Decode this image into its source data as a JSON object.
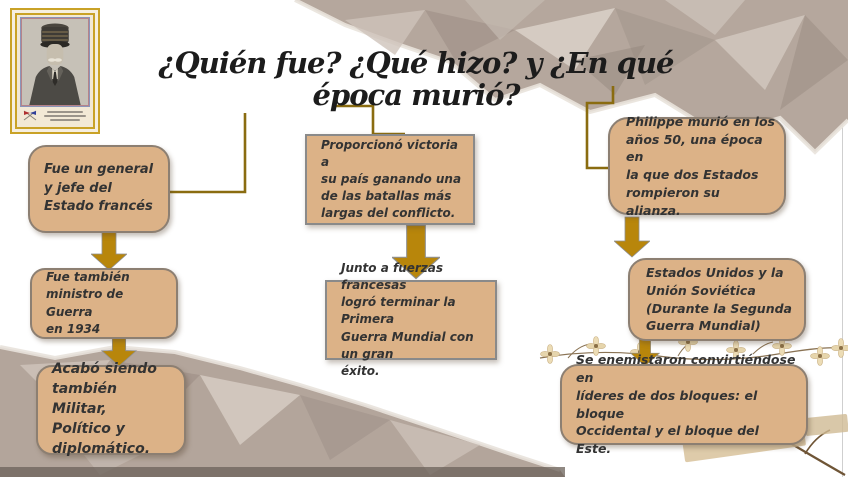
{
  "slide": {
    "title": "¿Quién fue? ¿Qué hizo? y ¿En qué época murió?"
  },
  "portrait": {
    "alt": "Retrato en blanco y negro de Philippe Pétain con quepis militar"
  },
  "flow": {
    "left": [
      {
        "text": "Fue un general\ny jefe del\nEstado francés"
      },
      {
        "text": "Fue también\nministro de Guerra\nen 1934"
      },
      {
        "text": "Acabó siendo\ntambién Militar,\nPolítico y\ndiplomático."
      }
    ],
    "middle": [
      {
        "text": "Proporcionó victoria a\nsu país ganando una\nde las batallas más\nlargas del conflicto."
      },
      {
        "text": "Junto a fuerzas francesas\nlogró terminar la Primera\nGuerra Mundial con un gran\néxito."
      }
    ],
    "right": [
      {
        "text": "Philippe murió en los\naños 50, una época en\nla que dos Estados\nrompieron su alianza."
      },
      {
        "text": " Estados Unidos y la\nUnión Soviética\n(Durante la Segunda\nGuerra Mundial)"
      },
      {
        "text": "Se enemistaron convirtiéndose en\nlíderes de dos bloques: el bloque\nOccidental y el bloque del Este."
      }
    ]
  },
  "colors": {
    "arrow_gold": "#b8860b",
    "connector_gold": "#8a6c10",
    "box_fill": "#dcb287",
    "box_border_rounded": "#8c7f72",
    "box_border_rect": "#8a8a8a",
    "paper": "#b3a69c",
    "title_ink": "#1c1c1c"
  }
}
